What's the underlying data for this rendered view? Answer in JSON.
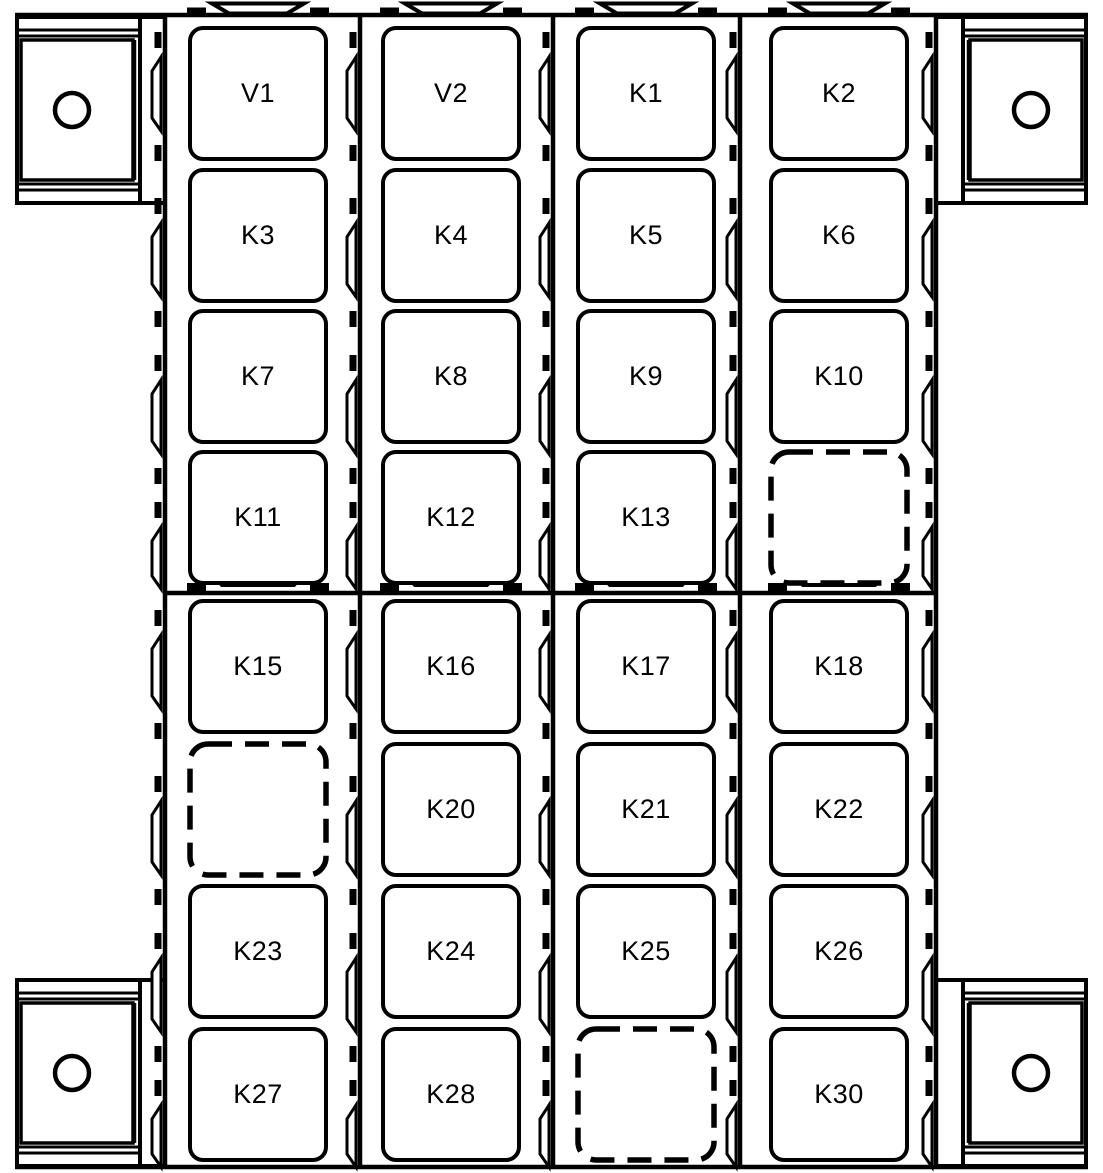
{
  "diagram": {
    "kind": "relay-box-layout-top-view",
    "background": "#ffffff",
    "line_color": "#000000",
    "mounting_brackets": {
      "count": 4,
      "positions": [
        "top-left",
        "top-right",
        "bottom-left",
        "bottom-right"
      ],
      "hole_shape": "circle"
    },
    "columns": 4,
    "rows": 8,
    "empty_slot_style": "dashed-outline",
    "slots": [
      {
        "row": 1,
        "col": 1,
        "label": "V1",
        "dashed": false
      },
      {
        "row": 1,
        "col": 2,
        "label": "V2",
        "dashed": false
      },
      {
        "row": 1,
        "col": 3,
        "label": "K1",
        "dashed": false
      },
      {
        "row": 1,
        "col": 4,
        "label": "K2",
        "dashed": false
      },
      {
        "row": 2,
        "col": 1,
        "label": "K3",
        "dashed": false
      },
      {
        "row": 2,
        "col": 2,
        "label": "K4",
        "dashed": false
      },
      {
        "row": 2,
        "col": 3,
        "label": "K5",
        "dashed": false
      },
      {
        "row": 2,
        "col": 4,
        "label": "K6",
        "dashed": false
      },
      {
        "row": 3,
        "col": 1,
        "label": "K7",
        "dashed": false
      },
      {
        "row": 3,
        "col": 2,
        "label": "K8",
        "dashed": false
      },
      {
        "row": 3,
        "col": 3,
        "label": "K9",
        "dashed": false
      },
      {
        "row": 3,
        "col": 4,
        "label": "K10",
        "dashed": false
      },
      {
        "row": 4,
        "col": 1,
        "label": "K11",
        "dashed": false
      },
      {
        "row": 4,
        "col": 2,
        "label": "K12",
        "dashed": false
      },
      {
        "row": 4,
        "col": 3,
        "label": "K13",
        "dashed": false
      },
      {
        "row": 4,
        "col": 4,
        "label": "",
        "dashed": true
      },
      {
        "row": 5,
        "col": 1,
        "label": "K15",
        "dashed": false
      },
      {
        "row": 5,
        "col": 2,
        "label": "K16",
        "dashed": false
      },
      {
        "row": 5,
        "col": 3,
        "label": "K17",
        "dashed": false
      },
      {
        "row": 5,
        "col": 4,
        "label": "K18",
        "dashed": false
      },
      {
        "row": 6,
        "col": 1,
        "label": "",
        "dashed": true
      },
      {
        "row": 6,
        "col": 2,
        "label": "K20",
        "dashed": false
      },
      {
        "row": 6,
        "col": 3,
        "label": "K21",
        "dashed": false
      },
      {
        "row": 6,
        "col": 4,
        "label": "K22",
        "dashed": false
      },
      {
        "row": 7,
        "col": 1,
        "label": "K23",
        "dashed": false
      },
      {
        "row": 7,
        "col": 2,
        "label": "K24",
        "dashed": false
      },
      {
        "row": 7,
        "col": 3,
        "label": "K25",
        "dashed": false
      },
      {
        "row": 7,
        "col": 4,
        "label": "K26",
        "dashed": false
      },
      {
        "row": 8,
        "col": 1,
        "label": "K27",
        "dashed": false
      },
      {
        "row": 8,
        "col": 2,
        "label": "K28",
        "dashed": false
      },
      {
        "row": 8,
        "col": 3,
        "label": "",
        "dashed": true
      },
      {
        "row": 8,
        "col": 4,
        "label": "K30",
        "dashed": false
      }
    ]
  }
}
